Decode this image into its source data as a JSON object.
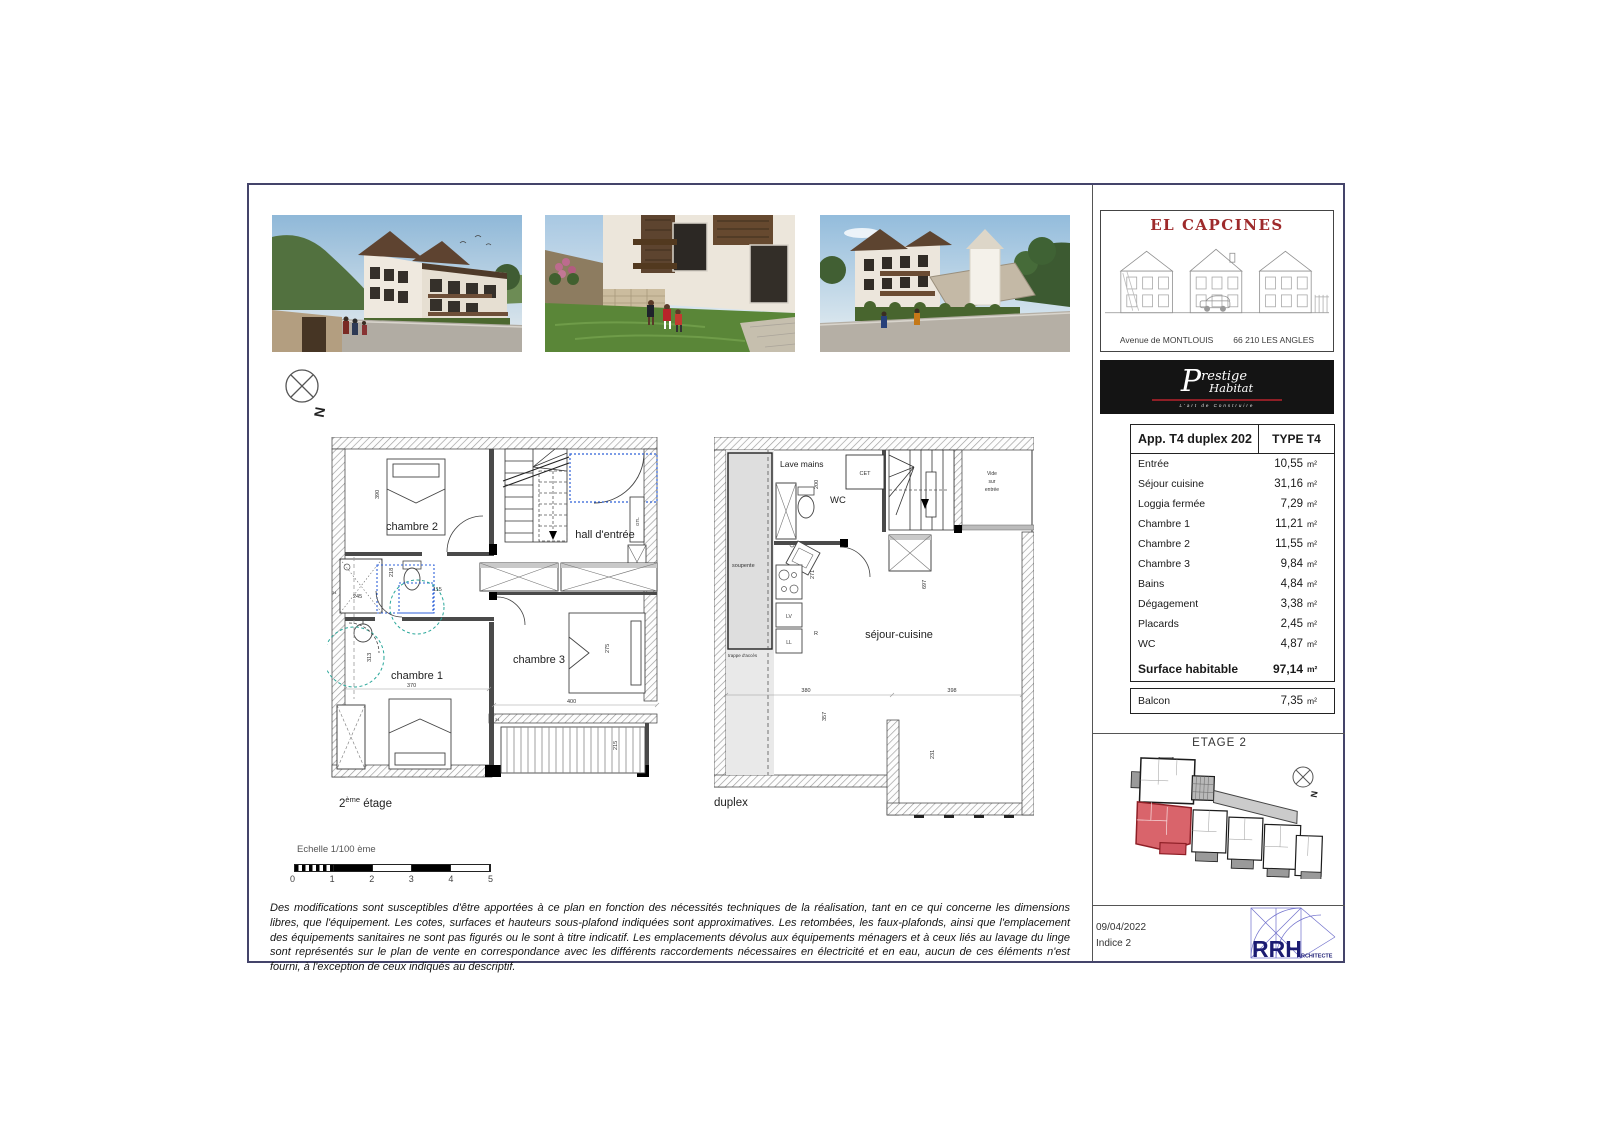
{
  "compass": {
    "north": "N"
  },
  "title_block": {
    "title": "EL CAPCINES",
    "street": "Avenue de MONTLOUIS",
    "city": "66 210 LES ANGLES"
  },
  "brand": {
    "p": "P",
    "rest": "restige",
    "habitat": "Habitat",
    "tagline": "L'art de Construire"
  },
  "apartment": {
    "header_left": "App. T4 duplex 202",
    "header_right": "TYPE T4",
    "unit": "m²",
    "rows": [
      {
        "label": "Entrée",
        "value": "10,55"
      },
      {
        "label": "Séjour cuisine",
        "value": "31,16"
      },
      {
        "label": "Loggia fermée",
        "value": "7,29"
      },
      {
        "label": "Chambre 1",
        "value": "11,21"
      },
      {
        "label": "Chambre 2",
        "value": "11,55"
      },
      {
        "label": "Chambre 3",
        "value": "9,84"
      },
      {
        "label": "Bains",
        "value": "4,84"
      },
      {
        "label": "Dégagement",
        "value": "3,38"
      },
      {
        "label": "Placards",
        "value": "2,45"
      },
      {
        "label": "WC",
        "value": "4,87"
      }
    ],
    "total": {
      "label": "Surface habitable",
      "value": "97,14"
    },
    "balcony": {
      "label": "Balcon",
      "value": "7,35"
    }
  },
  "etage": {
    "title": "ETAGE 2"
  },
  "footer": {
    "date": "09/04/2022",
    "indice": "Indice 2",
    "logo": "RRH",
    "logo_sub": "ARCHITECTE"
  },
  "plans": {
    "left": {
      "caption_num": "2",
      "caption_sup": "ème",
      "caption_rest": " étage",
      "rooms": {
        "chambre2": "chambre 2",
        "hall": "hall d'entrée",
        "chambre1": "chambre 1",
        "chambre3": "chambre 3",
        "gtl": "GTL"
      },
      "dims": {
        "d390": "390",
        "d245": "245",
        "d218": "218",
        "d115": "115",
        "d370": "370",
        "d313": "313",
        "d400": "400",
        "d275": "275",
        "d215": "215",
        "d34": "34"
      }
    },
    "right": {
      "caption": "duplex",
      "labels": {
        "lave_mains": "Lave mains",
        "cet": "CET",
        "wc": "WC",
        "vide_1": "Vide",
        "vide_2": "sur",
        "vide_3": "entrée",
        "soupente": "soupente",
        "trappe": "trappe d'accès",
        "lv": "LV",
        "ll": "LL",
        "r": "R",
        "sejour": "séjour-cuisine"
      },
      "dims": {
        "d200": "200",
        "d271": "271",
        "d697": "697",
        "d380": "380",
        "d398": "398",
        "d357": "357",
        "d231": "231"
      }
    }
  },
  "scale": {
    "label": "Echelle 1/100 ème",
    "ticks": [
      "0",
      "1",
      "2",
      "3",
      "4",
      "5"
    ]
  },
  "disclaimer": "Des modifications sont susceptibles d'être apportées à ce plan en fonction des nécessités techniques de la réalisation, tant en ce qui concerne les dimensions libres, que l'équipement. Les cotes, surfaces et hauteurs sous-plafond indiquées sont approximatives. Les retombées, les faux-plafonds, ainsi que l'emplacement des équipements sanitaires ne sont pas figurés ou le sont à titre indicatif. Les emplacements dévolus aux équipements ménagers et à ceux liés au lavage du linge sont représentés sur le plan de vente en correspondance avec les différents raccordements nécessaires en électricité et en eau, aucun de ces éléments n'est fourni, à l'exception de ceux indiqués au descriptif.",
  "colors": {
    "accent_red": "#9e2a2b",
    "highlight_unit": "#d9646b",
    "logo_blue": "#1b1b72",
    "frame": "#44446a"
  }
}
